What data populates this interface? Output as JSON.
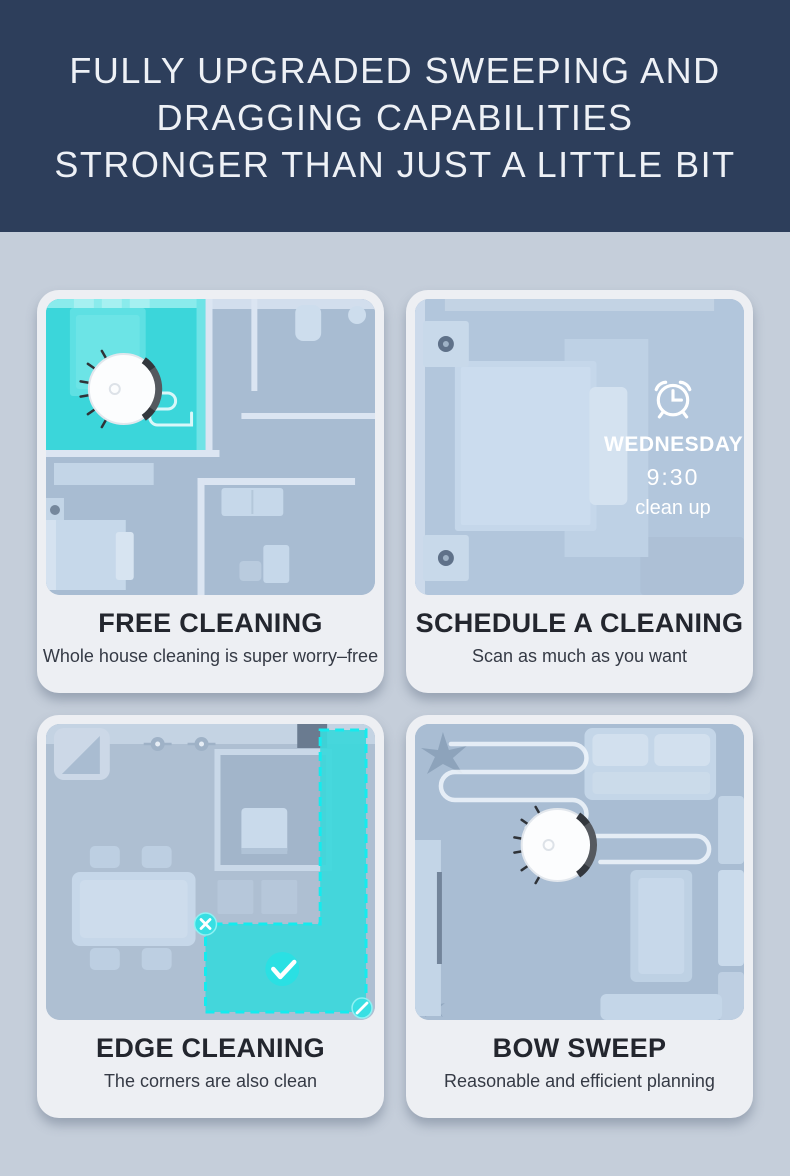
{
  "header": {
    "lines": [
      "FULLY UPGRADED SWEEPING AND",
      "DRAGGING CAPABILITIES",
      "STRONGER THAN JUST A LITTLE BIT"
    ]
  },
  "theme": {
    "header_bg": "#2d3e5b",
    "page_bg": "#c5ceda",
    "card_bg": "#edeff3",
    "floorplan_bg": "#a8bcd2",
    "highlight_cyan": "#3bd6da",
    "highlight_dash": "#14ebee",
    "title_color": "#23262e",
    "subtitle_color": "#353a45",
    "overlay_text_color": "#ffffff"
  },
  "cards": [
    {
      "id": "free-cleaning",
      "title": "FREE CLEANING",
      "subtitle": "Whole house cleaning is super worry–free",
      "illustration": "house-floor-plan-with-robot-vacuum-in-highlighted-room",
      "icons": [
        "robot-vacuum-icon",
        "cleaning-path-squiggle"
      ]
    },
    {
      "id": "schedule-a-cleaning",
      "title": "SCHEDULE A CLEANING",
      "subtitle": "Scan as much as you want",
      "illustration": "bedroom-top-view",
      "overlay": {
        "icon": "alarm-clock-icon",
        "day": "WEDNESDAY",
        "time": "9:30",
        "action": "clean up"
      }
    },
    {
      "id": "edge-cleaning",
      "title": "EDGE CLEANING",
      "subtitle": "The corners are also clean",
      "illustration": "kitchen-dining-plan-with-edge-zone-highlight",
      "icons": [
        "close-icon",
        "check-icon",
        "resize-handle-icon"
      ]
    },
    {
      "id": "bow-sweep",
      "title": "BOW SWEEP",
      "subtitle": "Reasonable and efficient planning",
      "illustration": "living-room-with-zigzag-path-and-robot-vacuum",
      "icons": [
        "robot-vacuum-icon",
        "zigzag-path"
      ]
    }
  ]
}
